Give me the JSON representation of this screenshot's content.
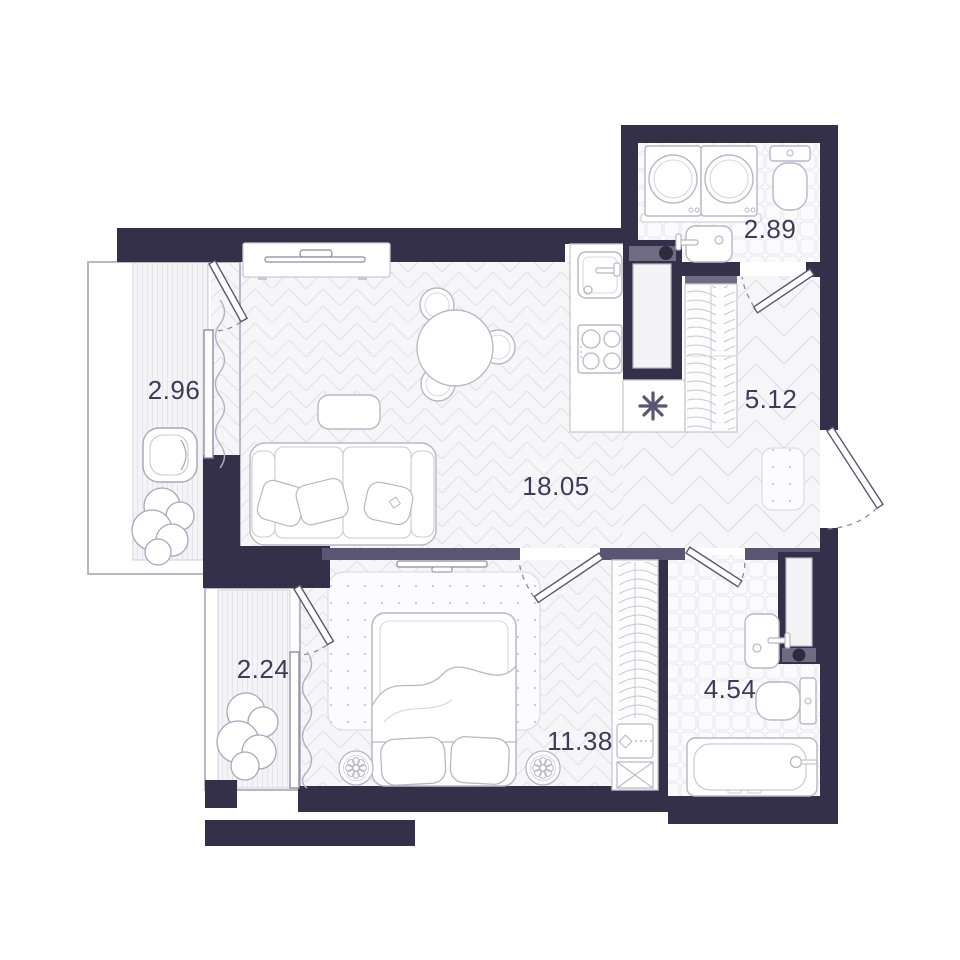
{
  "floor_plan": {
    "rooms": {
      "balcony_left": {
        "area": "2.96",
        "type": "balcony"
      },
      "bathroom_top": {
        "area": "2.89",
        "type": "bathroom"
      },
      "hallway": {
        "area": "5.12",
        "type": "hallway"
      },
      "living_kitchen": {
        "area": "18.05",
        "type": "living-kitchen"
      },
      "balcony_bottom": {
        "area": "2.24",
        "type": "balcony"
      },
      "bedroom": {
        "area": "11.38",
        "type": "bedroom"
      },
      "bathroom_bottom": {
        "area": "4.54",
        "type": "bathroom"
      }
    },
    "symbols": {
      "ventilation": "✳"
    },
    "icons": [
      "sofa-icon",
      "coffee-table-icon",
      "tv-console-icon",
      "dining-table-icon",
      "chair-icon",
      "kitchen-sink-icon",
      "stove-icon",
      "vent-shaft-icon",
      "vent-asterisk-icon",
      "wardrobe-icon",
      "washing-machine-icon",
      "toilet-icon",
      "bathroom-sink-icon",
      "bathtub-icon",
      "bed-icon",
      "rug-icon",
      "door-mat-icon",
      "pouf-flower-icon",
      "plant-icon",
      "armchair-icon",
      "door-leaf",
      "curtain-icon"
    ],
    "colors": {
      "wall": "#353049",
      "partition": "#5a5570",
      "cabinet_cap": "#6f6b82",
      "floor": "#f6f6f8",
      "furniture_line": "#b9b7c6",
      "label_text": "#3f3a57"
    }
  }
}
